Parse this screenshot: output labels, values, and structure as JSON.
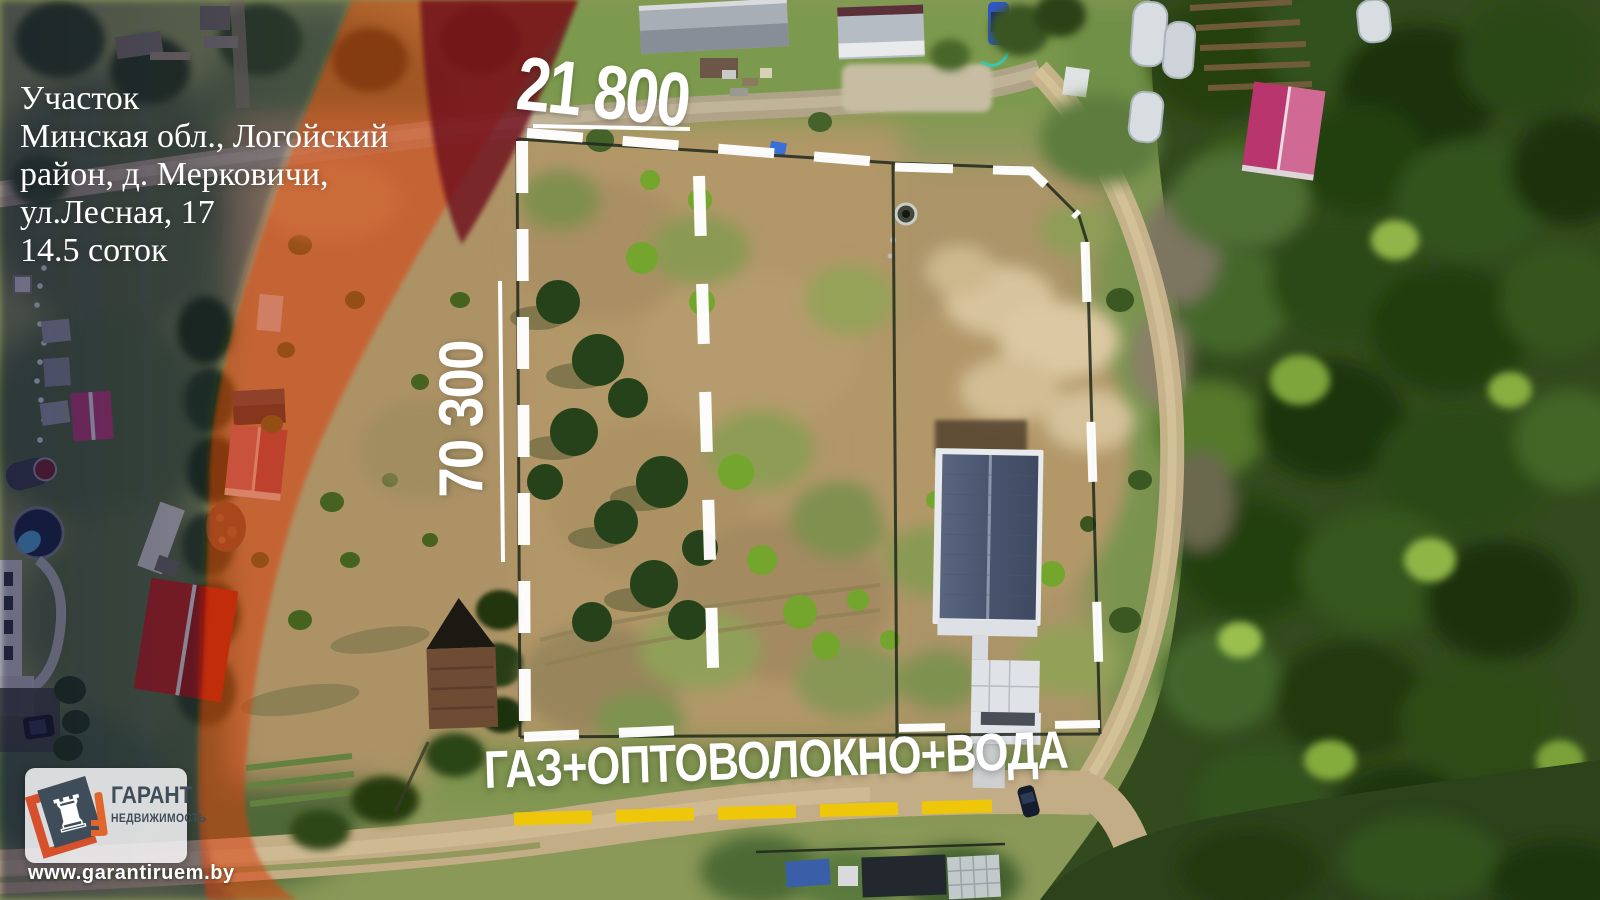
{
  "listing": {
    "title": "Участок",
    "address_line1": "Минская обл., Логойский",
    "address_line2": "район, д. Мерковичи,",
    "address_line3": "ул.Лесная, 17",
    "area": "14.5 соток"
  },
  "dimensions": {
    "width_label": "21 800",
    "depth_label": "70 300"
  },
  "utilities": {
    "label": "ГАЗ+ОПТОВОЛОКНО+ВОДА",
    "underline_color": "#eec60a"
  },
  "brand": {
    "name": "ГАРАНТ",
    "subtitle": "НЕДВИЖИМОСТЬ",
    "website": "www.garantiruem.by",
    "rook_glyph": "♜",
    "accent_orange": "#d6502b",
    "slate": "#3f4c59"
  },
  "overlay_colors": {
    "red_band": "#d84010",
    "dark_red_wedge": "#6e0e1a",
    "purple_tint": "#1a1240",
    "boundary_white": "#ffffff"
  }
}
